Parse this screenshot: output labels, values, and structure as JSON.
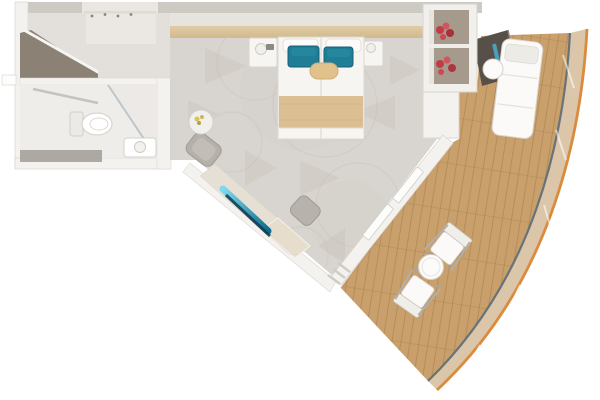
{
  "scene": {
    "type": "cruise-ship-stateroom-floor-plan-top-down-render",
    "rooms": {
      "entry": "entry-corridor",
      "bathroom": "bathroom",
      "bedroom": "bedroom",
      "balcony": "balcony-deck"
    },
    "objects": {
      "bathroom": [
        "toilet",
        "glass-shower",
        "vanity-sink",
        "towel-bar"
      ],
      "entry": [
        "open-wardrobe",
        "coat-hooks",
        "entry-door"
      ],
      "bedroom": [
        "double-bed",
        "nightstand-left",
        "nightstand-right",
        "bedside-lamps",
        "teal-pillows",
        "accent-bolster",
        "bed-runner",
        "side-table-with-flowers",
        "armchair",
        "vanity-desk",
        "teal-mirror-panel",
        "stool",
        "desk-bench",
        "wardrobe-block",
        "display-shelf-with-red-flowers",
        "gold-luggage-bench",
        "sliding-glass-door"
      ],
      "balcony": [
        "padded-lounger",
        "lounger-side-table",
        "privacy-partition",
        "deck-chair-upper",
        "deck-chair-lower",
        "round-deck-table",
        "teak-decking",
        "curved-glass-railing",
        "hull-edge"
      ]
    }
  },
  "palette": {
    "background": "#ffffff",
    "wall": "#f4f2ef",
    "wall_edge": "#d9d5cf",
    "wall_band": "#cdc9c3",
    "wall_face": "#e7e3dd",
    "entry_gap": "#eae7e2",
    "carpet": "#d8d5d0",
    "carpet_motif": "#c3bcb0",
    "carpet_ring": "#cbc3b7",
    "corridor_floor": "#e3dfda",
    "bathroom_floor": "#efedea",
    "floor_strip_gray": "#a09c95",
    "closet_dark": "#8b8174",
    "headboard": "#d2b88d",
    "headboard_hi": "#e0cda6",
    "bed_linen": "#f7f5f2",
    "bed_runner": "#dbbf92",
    "runner_stripe": "#cfb282",
    "pillow_teal": "#1f7d95",
    "pillow_teal_hi": "#27899f",
    "pillow_accent": "#e2c28c",
    "deck_wood": "#c9a06c",
    "deck_plank_line": "#a8824f",
    "railing_band": "#dcc6a9",
    "railing_glass_line": "#5b6b77",
    "hull_edge": "#db8b3e",
    "partition_dark": "#565049",
    "glass_teal": "#49a8c8",
    "mirror_teal_light": "#7fd9ee",
    "mirror_teal_dark": "#0d6b8c",
    "mirror_navy": "#123b4d",
    "desk_surface": "#e6dfd3",
    "bench_beige": "#e6ddcc",
    "stool_gray": "#b7b3ac",
    "chair_gray": "#b5b1aa",
    "shelf_interior": "#a59a8c",
    "red_item_1": "#c23b45",
    "red_item_2": "#d2545e",
    "red_item_3": "#a93039",
    "gold_accent": "#c9a852",
    "fixture_white": "#fcfbfa",
    "fixture_stroke": "#d5d1cb"
  }
}
